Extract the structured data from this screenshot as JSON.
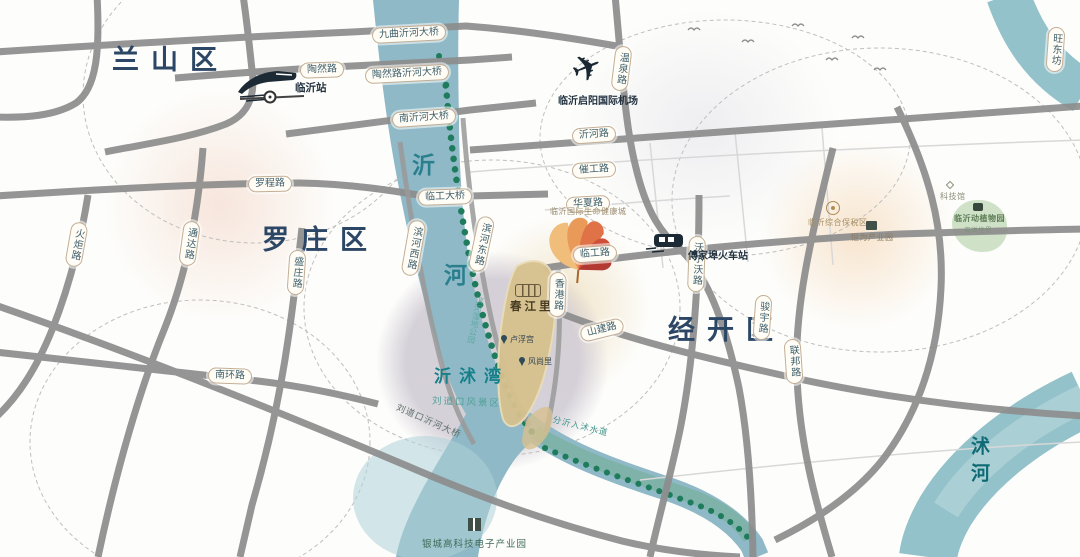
{
  "districts": {
    "lanshan": "兰山区",
    "luozhuang": "罗庄区",
    "jingkai": "经开区"
  },
  "rivers": {
    "yi_char1": "沂",
    "yi_char2": "河",
    "shu": "沭河",
    "yishu_bay": "沂沭湾",
    "fenyi_channel": "分沂入沭水道"
  },
  "roads": {
    "taoran": "陶然路",
    "wenquan": "温泉路",
    "yihe": "沂河路",
    "cuigong": "催工路",
    "huaxia": "华夏路",
    "lingong": "临工路",
    "hongkong": "香港路",
    "volvo": "沃尔沃路",
    "shanjian": "山建路",
    "binhe_west": "滨河西路",
    "binhe_east": "滨河东路",
    "luocheng": "罗程路",
    "huoju": "火炬路",
    "tongda": "通达路",
    "shengzhuang": "盛庄路",
    "nanhuan": "南环路",
    "junyu": "骏宇路",
    "lianbang": "联邦路",
    "wangdong": "旺东坊"
  },
  "bridges": {
    "jiuqu": "九曲沂河大桥",
    "taoran": "陶然路沂河大桥",
    "nanyihe": "南沂河大桥",
    "lingong": "临工大桥",
    "liudaokou": "刘道口沂河大桥"
  },
  "stations": {
    "linyi": "临沂站",
    "fujiabu": "傅家埠火车站"
  },
  "airport": {
    "name": "临沂启阳国际机场"
  },
  "project": {
    "name": "春江里",
    "poi_louvre": "卢浮宫",
    "poi_fengshang": "风尚里"
  },
  "places": {
    "health_city": "临沂国际生命健康城",
    "bonded_zone": "临沂综合保税区",
    "hengwei_park": "恒为产业园",
    "sci_museum": "科技馆",
    "zoo": "临沂动植物园",
    "zoo_sub": "海洋世界",
    "liudaokou_scenic": "刘道口风景区",
    "wetland": "滨河湿地公园",
    "industry_park": "银城高科技电子产业园"
  },
  "colors": {
    "river": "#8fb9c6",
    "trees": "#1e7c5c",
    "road": "#8d8d8d",
    "accent_leaf": "#d4503c",
    "label_teal": "#3f5f6b"
  }
}
